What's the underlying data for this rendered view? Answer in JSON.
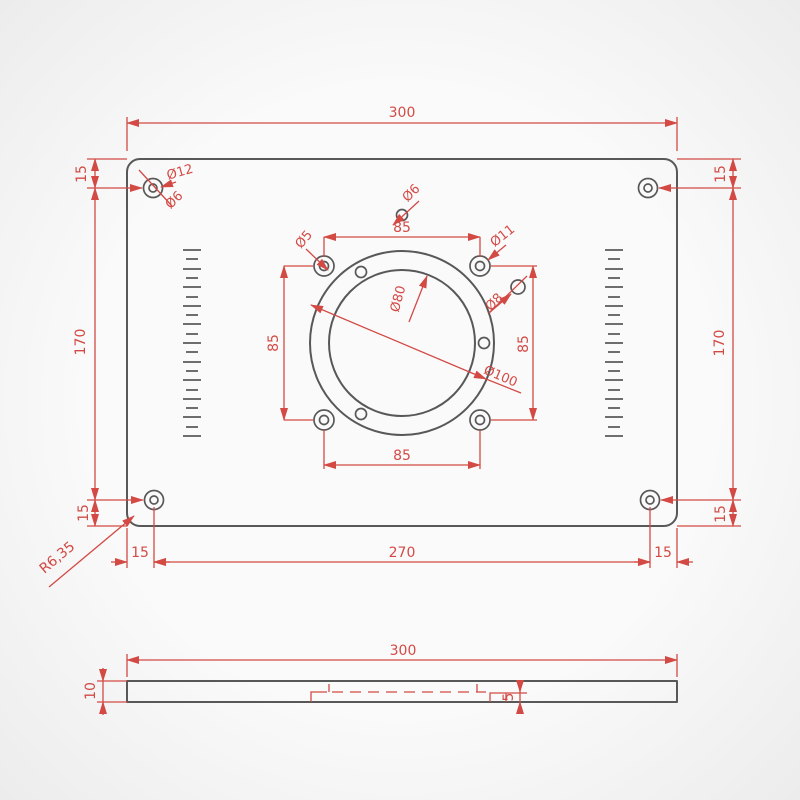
{
  "drawing": {
    "type": "technical-dimension-drawing",
    "colors": {
      "outline": "#585858",
      "dimension": "#d34a45",
      "background": "#f7f7f7"
    },
    "top_view": {
      "overall_width": "300",
      "height_between_holes_left": "170",
      "height_between_holes_right": "170",
      "margin_top_left": "15",
      "margin_top_right": "15",
      "margin_bottom_left": "15",
      "margin_bottom_right": "15",
      "bottom_offset_left": "15",
      "bottom_span": "270",
      "bottom_offset_right": "15",
      "corner_radius": "R6,35",
      "corner_hole_outer_dia": "Ø12",
      "corner_hole_inner_dia": "Ø6",
      "pilot_hole_dia": "Ø6",
      "bolt_hole_dia": "Ø5",
      "counterbore_dia": "Ø11",
      "side_hole_dia": "Ø8",
      "opening_dia": "Ø80",
      "recess_dia": "Ø100",
      "bolt_spacing_top": "85",
      "bolt_spacing_bottom": "85",
      "bolt_spacing_left": "85",
      "bolt_spacing_right": "85"
    },
    "side_view": {
      "overall_width": "300",
      "thickness": "10",
      "recess_depth": "5"
    }
  }
}
